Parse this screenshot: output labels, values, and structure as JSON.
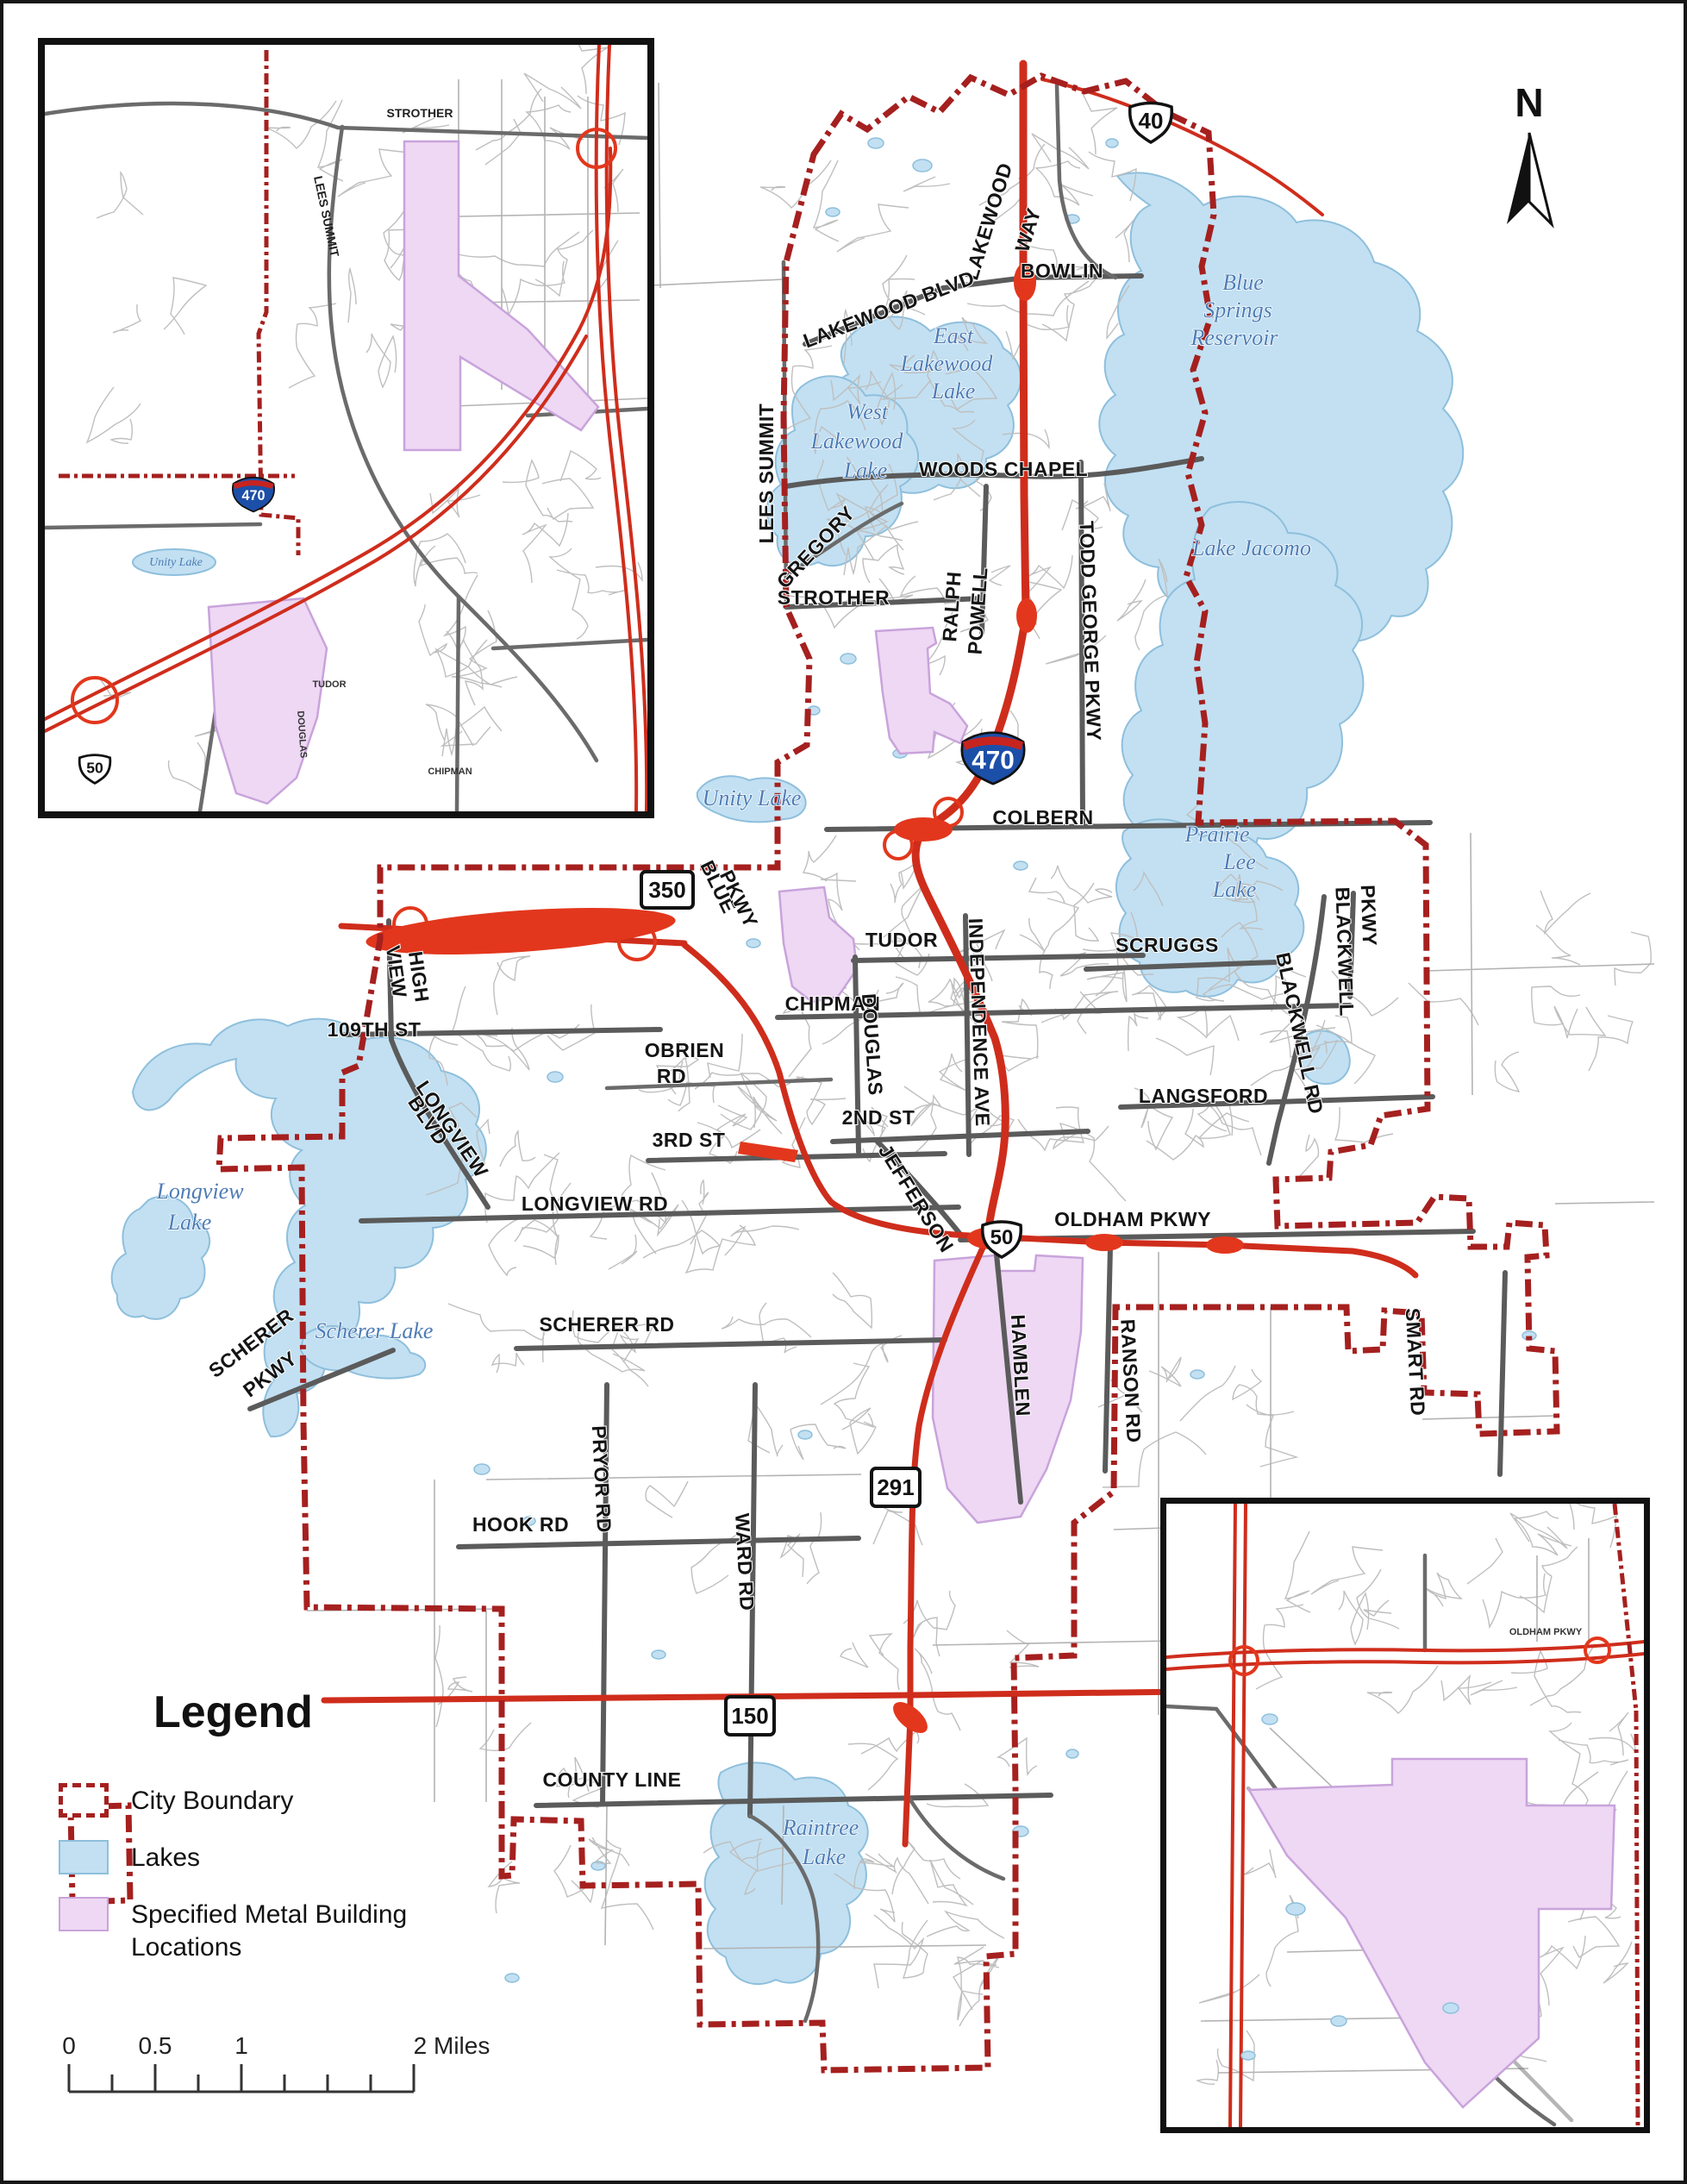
{
  "colors": {
    "boundary": "#a5201f",
    "lake_fill": "#c2e0f2",
    "lake_stroke": "#8ebfdc",
    "site_fill": "#eed8f4",
    "site_stroke": "#c9a3db",
    "road_major": "#5b5b5b",
    "road_minor": "#bfbfbf",
    "highway_red": "#cf2d1c",
    "water_label": "#4e7cb5",
    "interstate_blue": "#1c4fa8",
    "interstate_red": "#c6241f"
  },
  "north_arrow": {
    "label": "N"
  },
  "legend": {
    "title": "Legend",
    "items": [
      {
        "label": "City Boundary"
      },
      {
        "label": "Lakes"
      },
      {
        "label": "Specified Metal Building Locations"
      }
    ]
  },
  "scale_bar": {
    "tick_labels": [
      "0",
      "0.5",
      "1",
      "2 Miles"
    ]
  },
  "shields": {
    "us40": "40",
    "i470": "470",
    "mo350": "350",
    "us50": "50",
    "mo291": "291",
    "mo150": "150"
  },
  "road_labels": [
    {
      "t": "LAKEWOOD"
    },
    {
      "t": "WAY"
    },
    {
      "t": "BOWLIN"
    },
    {
      "t": "LAKEWOOD BLVD"
    },
    {
      "t": "WOODS CHAPEL"
    },
    {
      "t": "LEES SUMMIT"
    },
    {
      "t": "GREGORY"
    },
    {
      "t": "RALPH"
    },
    {
      "t": "POWELL"
    },
    {
      "t": "TODD GEORGE PKWY"
    },
    {
      "t": "STROTHER"
    },
    {
      "t": "COLBERN"
    },
    {
      "t": "BLUE"
    },
    {
      "t": "PKWY"
    },
    {
      "t": "TUDOR"
    },
    {
      "t": "SCRUGGS"
    },
    {
      "t": "BLACKWELL"
    },
    {
      "t": "PKWY"
    },
    {
      "t": "BLACKWELL RD"
    },
    {
      "t": "CHIPMAN"
    },
    {
      "t": "DOUGLAS"
    },
    {
      "t": "INDEPENDENCE AVE"
    },
    {
      "t": "LANGSFORD"
    },
    {
      "t": "VIEW"
    },
    {
      "t": "HIGH"
    },
    {
      "t": "109TH ST"
    },
    {
      "t": "OBRIEN"
    },
    {
      "t": "RD"
    },
    {
      "t": "3RD ST"
    },
    {
      "t": "2ND ST"
    },
    {
      "t": "JEFFERSON"
    },
    {
      "t": "LONGVIEW"
    },
    {
      "t": "BLVD"
    },
    {
      "t": "LONGVIEW RD"
    },
    {
      "t": "OLDHAM PKWY"
    },
    {
      "t": "SCHERER"
    },
    {
      "t": "PKWY"
    },
    {
      "t": "SCHERER RD"
    },
    {
      "t": "HAMBLEN"
    },
    {
      "t": "RANSON RD"
    },
    {
      "t": "SMART RD"
    },
    {
      "t": "PRYOR RD"
    },
    {
      "t": "HOOK RD"
    },
    {
      "t": "WARD RD"
    },
    {
      "t": "COUNTY LINE"
    }
  ],
  "lake_labels": [
    {
      "t": "Blue"
    },
    {
      "t": "Springs"
    },
    {
      "t": "Reservoir"
    },
    {
      "t": "East"
    },
    {
      "t": "Lakewood"
    },
    {
      "t": "Lake"
    },
    {
      "t": "West"
    },
    {
      "t": "Lakewood"
    },
    {
      "t": "Lake"
    },
    {
      "t": "Lake Jacomo"
    },
    {
      "t": "Unity Lake"
    },
    {
      "t": "Prairie"
    },
    {
      "t": "Lee"
    },
    {
      "t": "Lake"
    },
    {
      "t": "Longview"
    },
    {
      "t": "Lake"
    },
    {
      "t": "Scherer Lake"
    },
    {
      "t": "Raintree"
    },
    {
      "t": "Lake"
    }
  ],
  "inset_nw": {
    "labels": {
      "strother": "STROTHER",
      "lees_summit": "LEES SUMMIT",
      "tudor": "TUDOR",
      "chipman": "CHIPMAN",
      "douglas": "DOUGLAS",
      "lake": "Unity Lake"
    },
    "shields": {
      "i470": "470",
      "us50": "50"
    }
  },
  "inset_se": {
    "labels": {
      "oldham": "OLDHAM PKWY"
    }
  }
}
